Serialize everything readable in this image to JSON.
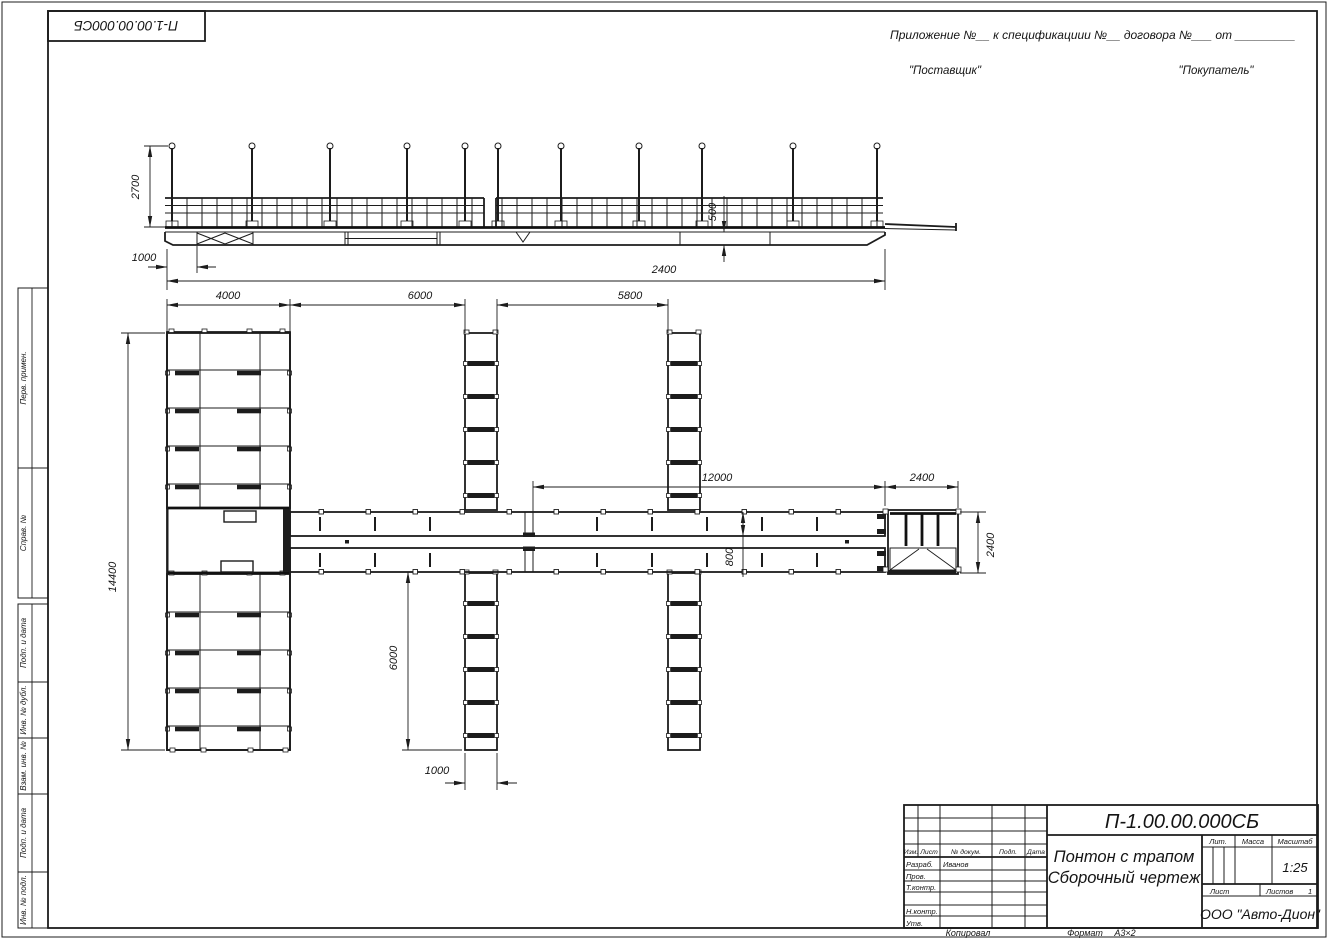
{
  "stamp_top_left": "П-1.00.00.000СБ",
  "header": {
    "line1": "Приложение №__    к спецификациии №__   договора №___  от _________",
    "supplier": "\"Поставщик\"",
    "buyer": "\"Покупатель\""
  },
  "margin": {
    "labels": [
      "Перв. примен.",
      "Справ. №",
      "Подп. и дата",
      "Инв. № дубл.",
      "Взам. инв. №",
      "Подп. и дата",
      "Инв. № подл."
    ]
  },
  "dims": {
    "side_height": "2700",
    "side_offset": "1000",
    "side_freeboard": "500",
    "side_length": "2400",
    "plan_4000": "4000",
    "plan_6000_top": "6000",
    "plan_5800": "5800",
    "plan_12000": "12000",
    "plan_2400_top": "2400",
    "plan_2400_right": "2400",
    "plan_800": "800",
    "plan_14400": "14400",
    "plan_6000_bottom": "6000",
    "plan_1000_bottom": "1000"
  },
  "title_block": {
    "designation": "П-1.00.00.000СБ",
    "title_line1": "Понтон с трапом",
    "title_line2": "Сборочный чертеж",
    "col_izm": "Изм.",
    "col_list": "Лист",
    "col_doc": "№ докум.",
    "col_podp": "Подп.",
    "col_data": "Дата",
    "row_razrab": "Разраб.",
    "razrab_name": "Иванов",
    "row_prov": "Пров.",
    "row_tkontr": "Т.контр.",
    "row_nkontr": "Н.контр.",
    "row_utv": "Утв.",
    "lit": "Лит.",
    "massa": "Масса",
    "masshtab": "Масштаб",
    "scale": "1:25",
    "list": "Лист",
    "listov": "Листов",
    "listov_value": "1",
    "company": "ООО \"Авто-Дион\""
  },
  "footer": {
    "copied": "Копировал",
    "format": "Формат",
    "format_value": "А3×2"
  }
}
